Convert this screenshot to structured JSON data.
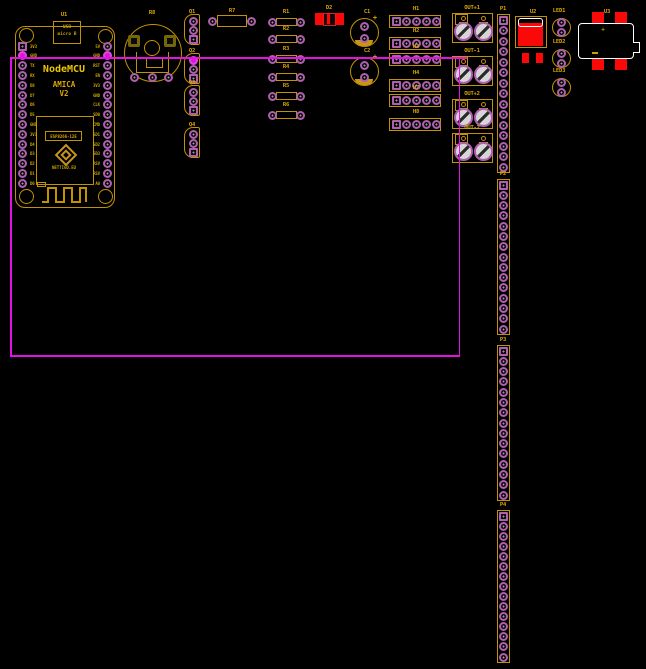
{
  "canvas": {
    "width": 646,
    "height": 669,
    "background": "#000000"
  },
  "colors": {
    "silk": "#C29200",
    "text": "#D9A900",
    "bright": "#EDC500",
    "pad_ring": "#AE5FAE",
    "net": "#E312E3",
    "red": "#FB0909",
    "white": "#FFFFFF",
    "terminal_fill": "#D6D6D6"
  },
  "nodemcu": {
    "ref": "U1",
    "title": "NodeMCU",
    "line1": "AMICA",
    "line2": "V2",
    "usb_line1": "USB",
    "usb_line2": "micro B",
    "esp_label": "ESP8266-12E",
    "esp_vendor": "NETTIGO.EU",
    "left_pins": [
      "3V3",
      "GND",
      "TX",
      "RX",
      "D8",
      "D7",
      "D6",
      "D5",
      "GND",
      "3V3",
      "D4",
      "D3",
      "D2",
      "D1",
      "D0"
    ],
    "right_pins": [
      "5V",
      "GND",
      "RST",
      "EN",
      "3V3",
      "GND",
      "CLK",
      "SD0",
      "CMD",
      "SD1",
      "SD2",
      "SD3",
      "RSV",
      "RSV",
      "A0"
    ],
    "gnd_pin_index": 1
  },
  "potentiometer": {
    "ref": "R8"
  },
  "smd_diode": {
    "ref": "D2"
  },
  "regulator": {
    "ref": "U2"
  },
  "module": {
    "ref": "U3",
    "polarity_mark": "+"
  },
  "capacitors": [
    {
      "ref": "C1",
      "cx": 364,
      "cy": 32,
      "polarity_mark": "+"
    },
    {
      "ref": "C2",
      "cx": 364,
      "cy": 71,
      "polarity_mark": "+"
    }
  ],
  "resistors": [
    {
      "ref": "R7",
      "cx": 232,
      "cy": 21,
      "body_w": 30,
      "body_h": 12,
      "pad_dx": 19.5
    },
    {
      "ref": "R1",
      "cx": 286,
      "cy": 22,
      "body_w": 21,
      "body_h": 8,
      "pad_dx": 14
    },
    {
      "ref": "R2",
      "cx": 286,
      "cy": 39,
      "body_w": 21,
      "body_h": 8,
      "pad_dx": 14
    },
    {
      "ref": "R3",
      "cx": 286,
      "cy": 59,
      "body_w": 21,
      "body_h": 8,
      "pad_dx": 14
    },
    {
      "ref": "R4",
      "cx": 286,
      "cy": 77,
      "body_w": 21,
      "body_h": 8,
      "pad_dx": 14
    },
    {
      "ref": "R5",
      "cx": 286,
      "cy": 96,
      "body_w": 21,
      "body_h": 8,
      "pad_dx": 14
    },
    {
      "ref": "R6",
      "cx": 286,
      "cy": 115,
      "body_w": 21,
      "body_h": 8,
      "pad_dx": 14
    }
  ],
  "transistors": [
    {
      "ref": "Q1",
      "x": 193,
      "y": 21,
      "net_pad": -1
    },
    {
      "ref": "Q2",
      "x": 193,
      "y": 60,
      "net_pad": 0
    },
    {
      "ref": "Q3",
      "x": 193,
      "y": 92,
      "net_pad": -1
    },
    {
      "ref": "Q4",
      "x": 193,
      "y": 134,
      "net_pad": -1
    }
  ],
  "headers": [
    {
      "ref": "H1",
      "x": 389,
      "y": 15
    },
    {
      "ref": "H2",
      "x": 389,
      "y": 37
    },
    {
      "ref": "H3",
      "x": 389,
      "y": 53
    },
    {
      "ref": "H4",
      "x": 389,
      "y": 79
    },
    {
      "ref": "H7",
      "x": 389,
      "y": 94
    },
    {
      "ref": "H8",
      "x": 389,
      "y": 118
    }
  ],
  "terminals": [
    {
      "ref": "OUT+1",
      "x": 452,
      "y": 13
    },
    {
      "ref": "OUT-1",
      "x": 452,
      "y": 56
    },
    {
      "ref": "OUT+2",
      "x": 452,
      "y": 99
    },
    {
      "ref": "OUT-2",
      "x": 452,
      "y": 133
    }
  ],
  "pin_strips": [
    {
      "ref": "P1",
      "x": 497,
      "y": 14,
      "height": 159,
      "pins": 15
    },
    {
      "ref": "P2",
      "x": 497,
      "y": 179,
      "height": 156,
      "pins": 15
    },
    {
      "ref": "P3",
      "x": 497,
      "y": 345,
      "height": 156,
      "pins": 15
    },
    {
      "ref": "P4",
      "x": 497,
      "y": 510,
      "height": 153,
      "pins": 15
    }
  ],
  "leds": [
    {
      "ref": "LED1",
      "cx": 561,
      "cy": 27
    },
    {
      "ref": "LED2",
      "cx": 561,
      "cy": 58
    },
    {
      "ref": "LED3",
      "cx": 561,
      "cy": 87
    }
  ],
  "net_highlight": {
    "color": "#E312E3",
    "left_x": 10,
    "top_y": 58,
    "right_x": 459,
    "bottom_y": 356,
    "stub_end_x": 466
  }
}
